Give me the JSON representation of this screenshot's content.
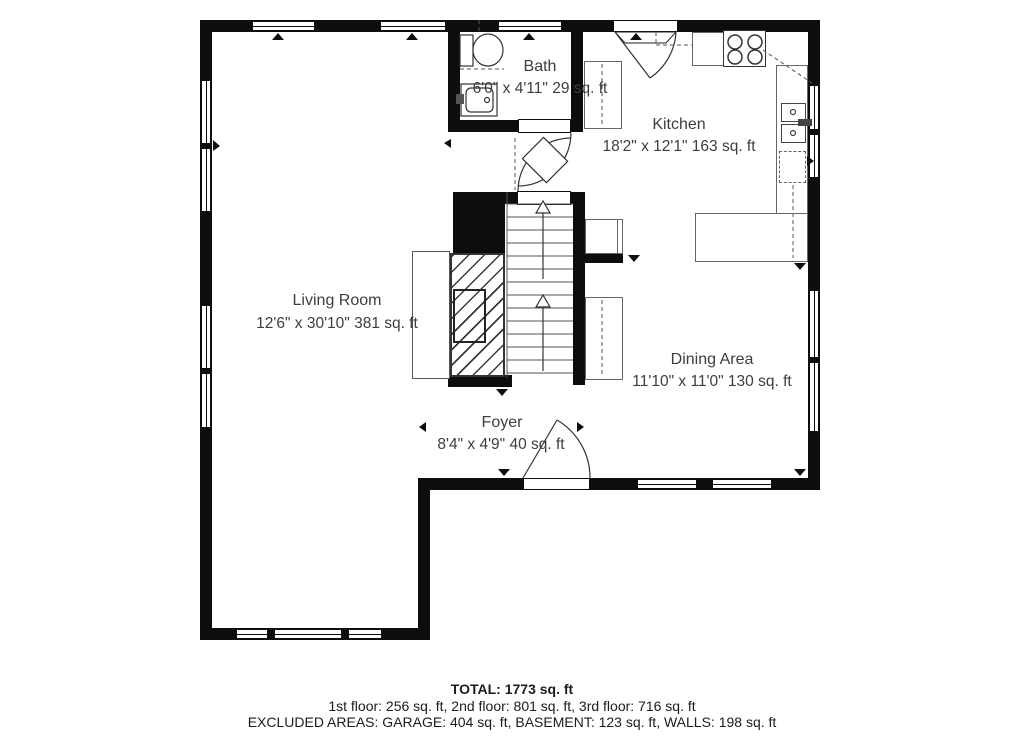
{
  "plan": {
    "type": "floor-plan",
    "rooms": {
      "bath": {
        "name": "Bath",
        "dims": "6'0\" x 4'11\" 29 sq. ft"
      },
      "kitchen": {
        "name": "Kitchen",
        "dims": "18'2\" x 12'1\" 163 sq. ft"
      },
      "living_room": {
        "name": "Living Room",
        "dims": "12'6\" x 30'10\" 381 sq. ft"
      },
      "dining_area": {
        "name": "Dining Area",
        "dims": "11'10\" x 11'0\" 130 sq. ft"
      },
      "foyer": {
        "name": "Foyer",
        "dims": "8'4\" x 4'9\" 40 sq. ft"
      }
    },
    "fixtures": [
      "toilet",
      "bath-sink",
      "kitchen-sink",
      "stove",
      "dishwasher",
      "fireplace",
      "stairs-up"
    ],
    "colors": {
      "wall": "#0d0d0d",
      "text": "#3d3d3d",
      "counter_line": "#666666"
    }
  },
  "summary": {
    "total": "TOTAL: 1773 sq. ft",
    "floors": "1st floor: 256 sq. ft, 2nd floor: 801 sq. ft, 3rd floor: 716 sq. ft",
    "excluded": "EXCLUDED AREAS: GARAGE: 404 sq. ft, BASEMENT: 123 sq. ft, WALLS: 198 sq. ft"
  }
}
